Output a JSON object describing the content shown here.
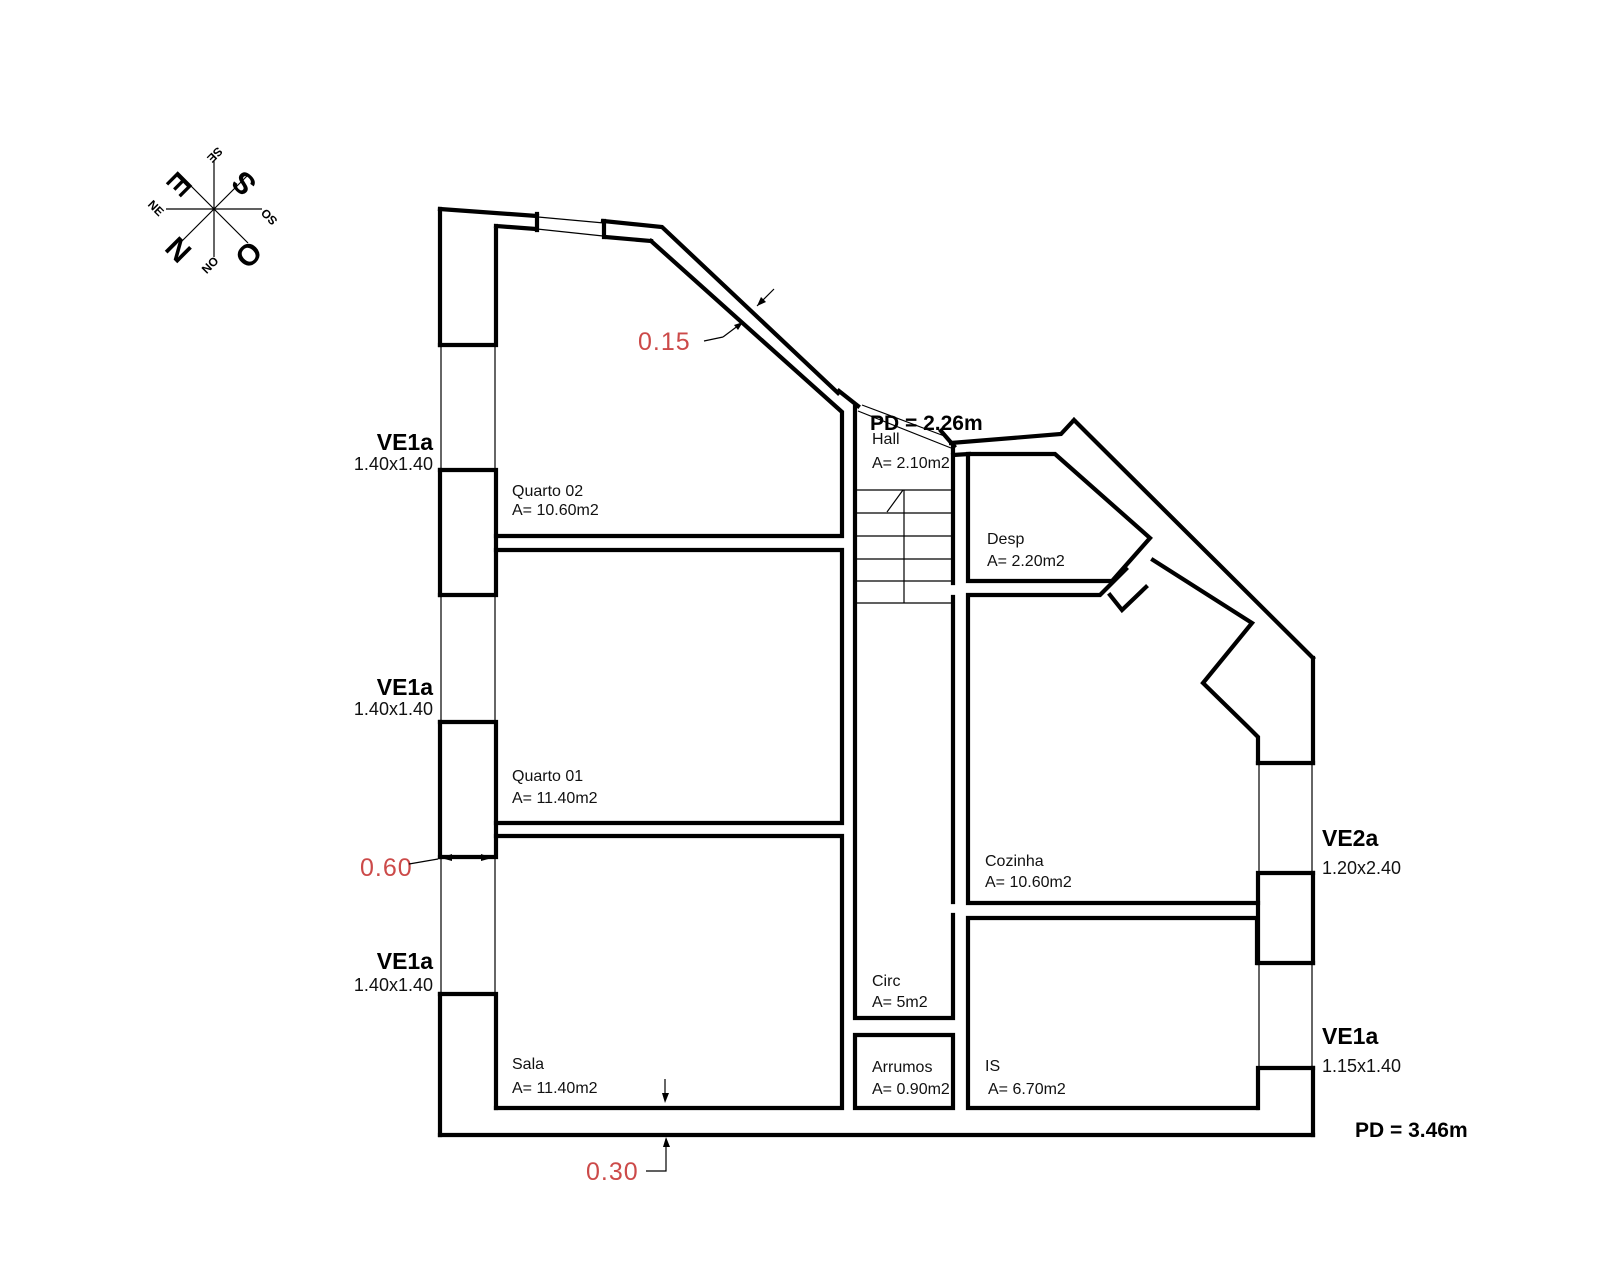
{
  "compass": {
    "points": [
      {
        "dir": "se",
        "label": "SE"
      },
      {
        "dir": "s",
        "label": "S"
      },
      {
        "dir": "so",
        "label": "SO"
      },
      {
        "dir": "o",
        "label": "O"
      },
      {
        "dir": "no",
        "label": "NO"
      },
      {
        "dir": "n",
        "label": "N"
      },
      {
        "dir": "ne",
        "label": "NE"
      },
      {
        "dir": "e",
        "label": "E"
      }
    ]
  },
  "rooms": [
    {
      "name": "Quarto 02",
      "area": "A= 10.60m2"
    },
    {
      "name": "Quarto 01",
      "area": "A= 11.40m2"
    },
    {
      "name": "Sala",
      "area": "A= 11.40m2"
    },
    {
      "name": "Hall",
      "area": "A= 2.10m2"
    },
    {
      "name": "Desp",
      "area": "A= 2.20m2"
    },
    {
      "name": "Cozinha",
      "area": "A= 10.60m2"
    },
    {
      "name": "Circ",
      "area": "A= 5m2"
    },
    {
      "name": "Arrumos",
      "area": "A= 0.90m2"
    },
    {
      "name": "IS",
      "area": "A= 6.70m2"
    }
  ],
  "windows": [
    {
      "label": "VE1a",
      "size": "1.40x1.40"
    },
    {
      "label": "VE1a",
      "size": "1.40x1.40"
    },
    {
      "label": "VE1a",
      "size": "1.40x1.40"
    },
    {
      "label": "VE2a",
      "size": "1.20x2.40"
    },
    {
      "label": "VE1a",
      "size": "1.15x1.40"
    }
  ],
  "ceiling_heights": [
    {
      "label": "PD = 2.26m"
    },
    {
      "label": "PD = 3.46m"
    }
  ],
  "dimensions": [
    {
      "value": "0.15"
    },
    {
      "value": "0.60"
    },
    {
      "value": "0.30"
    }
  ],
  "colors": {
    "wall": "#000000",
    "dimension_text": "#cc4a49",
    "background": "#ffffff"
  }
}
